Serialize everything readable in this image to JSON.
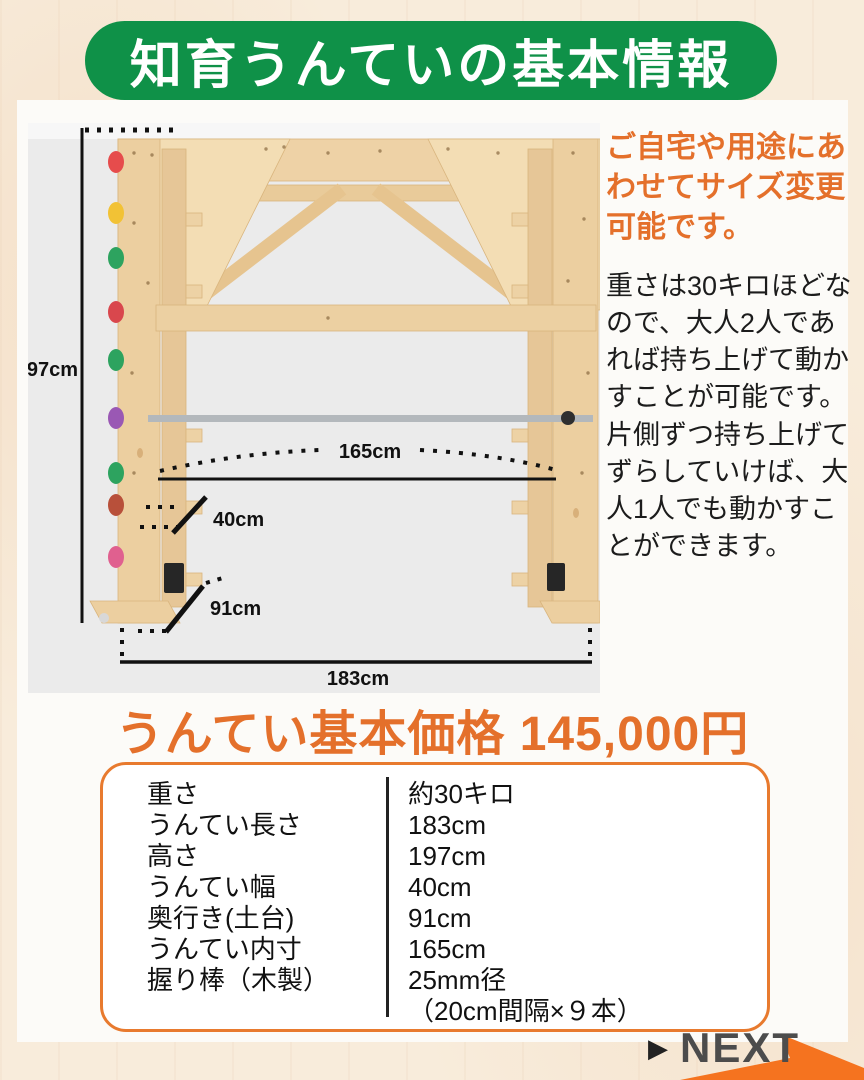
{
  "banner": {
    "title": "知育うんていの基本情報"
  },
  "diagram": {
    "dim_height": "197cm",
    "dim_inner": "165cm",
    "dim_width": "40cm",
    "dim_depth": "91cm",
    "dim_length": "183cm"
  },
  "info": {
    "highlight": "ご自宅や用途にあわせてサイズ変更可能です。",
    "body1": "重さは30キロほどなので、大人2人であれば持ち上げて動かすことが可能です。",
    "body2": "片側ずつ持ち上げてずらしていけば、大人1人でも動かすことができます。"
  },
  "price": {
    "heading": "うんてい基本価格 145,000円"
  },
  "spec_table": {
    "rows": [
      {
        "label": "重さ",
        "value": "約30キロ"
      },
      {
        "label": "うんてい長さ",
        "value": "183cm"
      },
      {
        "label": "高さ",
        "value": "197cm"
      },
      {
        "label": "うんてい幅",
        "value": "40cm"
      },
      {
        "label": "奥行き(土台)",
        "value": "91cm"
      },
      {
        "label": "うんてい内寸",
        "value": "165cm"
      },
      {
        "label": "握り棒（木製）",
        "value": "25mm径",
        "note": "（20cm間隔×９本）"
      }
    ]
  },
  "next": {
    "icon": "▶",
    "label": "NEXT"
  },
  "colors": {
    "banner_green": "#0f9148",
    "accent_orange": "#e4702b",
    "table_border_orange": "#e87a2e",
    "arrow_orange": "#f5731f",
    "photo_background": "#ebebeb",
    "page_background": "#f8ecdb"
  }
}
